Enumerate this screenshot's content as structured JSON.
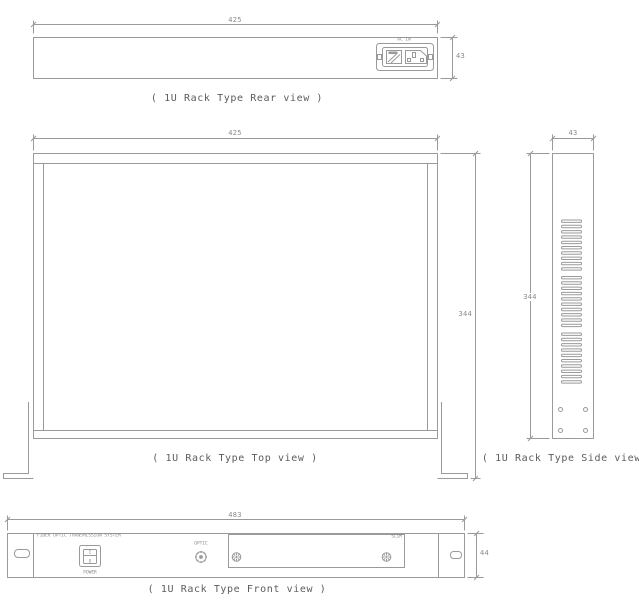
{
  "drawing": {
    "line_color": "#9a9a9a",
    "dimension_text_color": "#8a8a8a",
    "caption_text_color": "#5c5c5c",
    "background": "#ffffff"
  },
  "rear_view": {
    "caption": "( 1U Rack Type Rear view )",
    "width_dim": "425",
    "height_dim": "43",
    "ac_inlet_label": "AC IN"
  },
  "top_view": {
    "caption": "( 1U Rack Type Top view )",
    "width_dim": "425",
    "depth_dim": "344"
  },
  "side_view": {
    "caption": "( 1U Rack Type Side view )",
    "width_dim": "43",
    "height_dim": "344"
  },
  "front_view": {
    "caption": "( 1U Rack Type Front view )",
    "width_dim": "483",
    "height_dim": "44",
    "brand_label": "FIBER OPTIC TRANSMISSION SYSTEM",
    "power_switch": {
      "label": "POWER",
      "on": "I",
      "off": "O"
    },
    "optic_label": "OPTIC",
    "plate_label": "SLIM"
  }
}
